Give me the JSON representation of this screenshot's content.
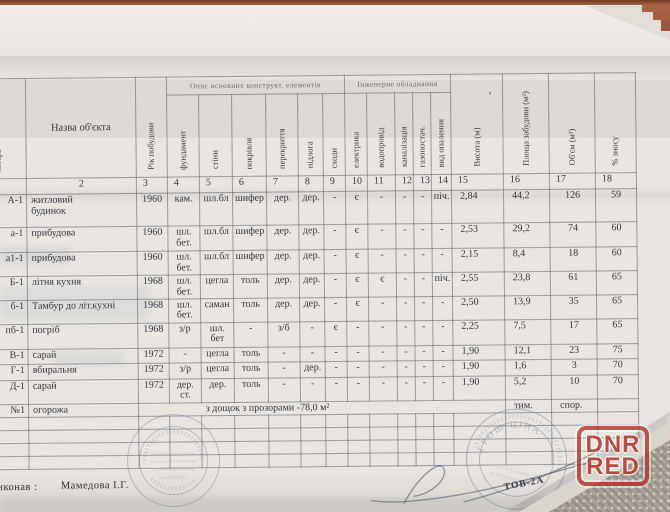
{
  "watermark": {
    "line1": "DNR",
    "line2": "RED",
    "color": "#b23229"
  },
  "table": {
    "group1": "Опис основних конструкт. елементів",
    "group2": "Інженерне обладнання",
    "columns": [
      {
        "num": "1",
        "label": "літера"
      },
      {
        "num": "2",
        "label": "Назва об'єкта"
      },
      {
        "num": "3",
        "label": "Рік побудови"
      },
      {
        "num": "4",
        "label": "фундамент"
      },
      {
        "num": "5",
        "label": "стіни"
      },
      {
        "num": "6",
        "label": "покрівля"
      },
      {
        "num": "7",
        "label": "перекриття"
      },
      {
        "num": "8",
        "label": "підлога"
      },
      {
        "num": "9",
        "label": "сходи"
      },
      {
        "num": "10",
        "label": "електрика"
      },
      {
        "num": "11",
        "label": "водопровід"
      },
      {
        "num": "12",
        "label": "каналізація"
      },
      {
        "num": "13",
        "label": "газопостач."
      },
      {
        "num": "14",
        "label": "вид опалення"
      },
      {
        "num": "15",
        "label": "Висота (м)"
      },
      {
        "num": "16",
        "label": "Площа забудови (м²)"
      },
      {
        "num": "17",
        "label": "Об'єм (м³)"
      },
      {
        "num": "18",
        "label": "% зносу"
      }
    ],
    "rows": [
      [
        "А-1",
        "житловий\nбудинок",
        "1960",
        "кам.",
        "шл.бл",
        "шифер",
        "дер.",
        "дер.",
        "-",
        "є",
        "-",
        "-",
        "-",
        "піч.",
        "2,84",
        "44,2",
        "126",
        "59"
      ],
      [
        "а-1",
        "прибудова",
        "1960",
        "шл.\nбет.",
        "шл.бл",
        "шифер",
        "дер.",
        "дер.",
        "-",
        "є",
        "-",
        "-",
        "-",
        "-",
        "2,53",
        "29,2",
        "74",
        "60"
      ],
      [
        "а1-1",
        "прибудова",
        "1960",
        "шл.\nбет.",
        "шл.бл",
        "шифер",
        "дер.",
        "дер.",
        "-",
        "є",
        "-",
        "-",
        "-",
        "-",
        "2,15",
        "8,4",
        "18",
        "60"
      ],
      [
        "Б-1",
        "літня кухня",
        "1968",
        "шл.\nбет.",
        "цегла",
        "толь",
        "дер.",
        "дер.",
        "-",
        "є",
        "є",
        "-",
        "-",
        "піч.",
        "2,55",
        "23,8",
        "61",
        "65"
      ],
      [
        "б-1",
        "Тамбур до літ.кухні",
        "1968",
        "шл.\nбет.",
        "саман",
        "толь",
        "дер.",
        "дер.",
        "-",
        "є",
        "-",
        "-",
        "-",
        "-",
        "2,50",
        "13,9",
        "35",
        "65"
      ],
      [
        "пб-1",
        "погріб",
        "1968",
        "з/р",
        "шл.\nбет",
        "-",
        "з/б",
        "-",
        "є",
        "-",
        "-",
        "-",
        "-",
        "-",
        "2,25",
        "7,5",
        "17",
        "65"
      ],
      [
        "В-1",
        "сарай",
        "1972",
        "-",
        "цегла",
        "толь",
        "-",
        "-",
        "-",
        "-",
        "-",
        "-",
        "-",
        "-",
        "1,90",
        "12,1",
        "23",
        "75"
      ],
      [
        "Г-1",
        "вбиральня",
        "1972",
        "з/р",
        "цегла",
        "толь",
        "-",
        "дер.",
        "-",
        "-",
        "-",
        "-",
        "-",
        "-",
        "1,90",
        "1,6",
        "3",
        "70"
      ],
      [
        "Д-1",
        "сарай",
        "1972",
        "дер.\nст.",
        "дер.",
        "толь",
        "-",
        "-",
        "-",
        "-",
        "-",
        "-",
        "-",
        "-",
        "1,90",
        "5,2",
        "10",
        "70"
      ]
    ],
    "fence_row": {
      "code": "№1",
      "name": "огорожа",
      "desc": "з дощок з прозорами -78,0 м²",
      "col16": "тим.",
      "col17": "спор.",
      "col18": ""
    },
    "empty_rows": 4
  },
  "footer": {
    "executor_label": "Виконав :",
    "executor_name": "Мамедова І.Г.",
    "stamp_caption": "ТОВ-2А",
    "stamp2_arc": "ГРОШ ЦІНА"
  },
  "marks": {
    "pen_mark": "ʼ"
  }
}
